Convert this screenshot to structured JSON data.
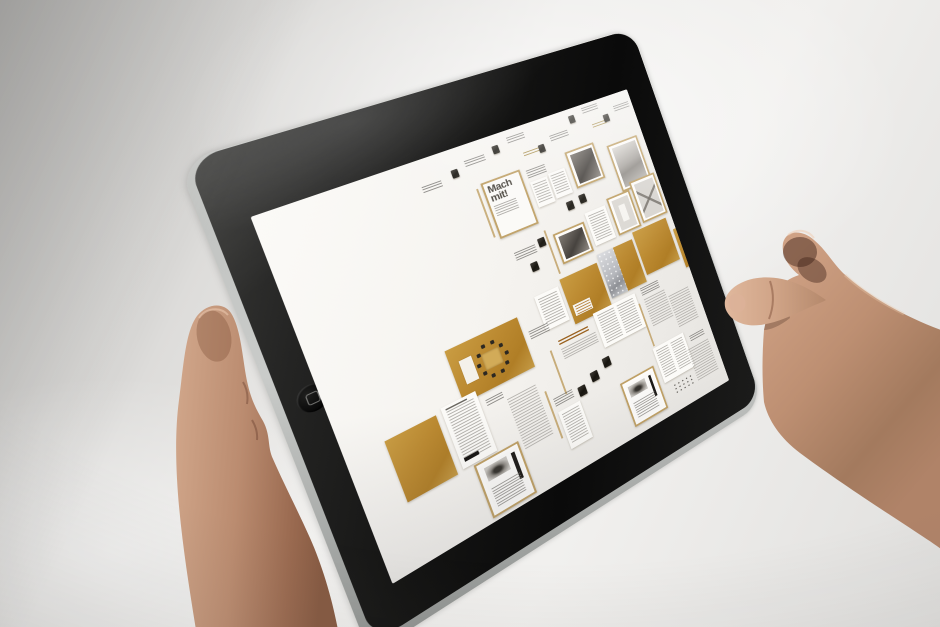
{
  "colors": {
    "accent_orange": "#bb8930",
    "frame_tan": "#bfa065",
    "paper": "#f5f3ef",
    "rim_silver": "#c9cbc9",
    "skin_light": "#d8b098",
    "skin_mid": "#c2987c",
    "skin_dark": "#8d5f48"
  },
  "screen": {
    "cover_title": "Mach mit!",
    "items": [
      {
        "t": "caption",
        "x": 148,
        "y": 28,
        "w": 20,
        "h": 7
      },
      {
        "t": "thumb",
        "x": 180,
        "y": 22,
        "w": 7,
        "h": 9
      },
      {
        "t": "caption",
        "x": 196,
        "y": 17,
        "w": 22,
        "h": 7
      },
      {
        "t": "thumb",
        "x": 228,
        "y": 12,
        "w": 7,
        "h": 9
      },
      {
        "t": "caption",
        "x": 246,
        "y": 8,
        "w": 20,
        "h": 7
      },
      {
        "t": "hlines",
        "x": 258,
        "y": 30,
        "w": 18,
        "h": 5
      },
      {
        "t": "thumb",
        "x": 276,
        "y": 28,
        "w": 7,
        "h": 9
      },
      {
        "t": "caption",
        "x": 292,
        "y": 22,
        "w": 22,
        "h": 7
      },
      {
        "t": "thumb",
        "x": 320,
        "y": 8,
        "w": 7,
        "h": 9
      },
      {
        "t": "caption",
        "x": 338,
        "y": 4,
        "w": 20,
        "h": 7
      },
      {
        "t": "hlines",
        "x": 344,
        "y": 26,
        "w": 18,
        "h": 5
      },
      {
        "t": "thumb",
        "x": 360,
        "y": 20,
        "w": 7,
        "h": 9
      },
      {
        "t": "caption",
        "x": 376,
        "y": 14,
        "w": 20,
        "h": 7
      },
      {
        "t": "vline",
        "x": 198,
        "y": 50,
        "w": 2,
        "h": 56
      },
      {
        "t": "cover",
        "x": 204,
        "y": 46,
        "w": 44,
        "h": 64
      },
      {
        "t": "caption",
        "x": 254,
        "y": 50,
        "w": 22,
        "h": 9
      },
      {
        "t": "textpage",
        "x": 254,
        "y": 64,
        "w": 20,
        "h": 30
      },
      {
        "t": "textpage",
        "x": 276,
        "y": 62,
        "w": 20,
        "h": 30
      },
      {
        "t": "framed",
        "v": "dark",
        "x": 302,
        "y": 46,
        "w": 36,
        "h": 44
      },
      {
        "t": "thumb",
        "x": 284,
        "y": 100,
        "w": 8,
        "h": 10
      },
      {
        "t": "thumb",
        "x": 300,
        "y": 98,
        "w": 8,
        "h": 10
      },
      {
        "t": "framed",
        "v": "photo",
        "x": 352,
        "y": 56,
        "w": 40,
        "h": 58
      },
      {
        "t": "caption",
        "x": 340,
        "y": 122,
        "w": 20,
        "h": 7
      },
      {
        "t": "vline",
        "x": 250,
        "y": 120,
        "w": 2,
        "h": 52
      },
      {
        "t": "caption",
        "x": 212,
        "y": 130,
        "w": 24,
        "h": 9
      },
      {
        "t": "thumb",
        "x": 240,
        "y": 126,
        "w": 8,
        "h": 10
      },
      {
        "t": "thumb",
        "x": 224,
        "y": 148,
        "w": 8,
        "h": 10
      },
      {
        "t": "framed",
        "v": "dark",
        "x": 258,
        "y": 128,
        "w": 38,
        "h": 36
      },
      {
        "t": "textpage",
        "x": 300,
        "y": 120,
        "w": 26,
        "h": 40
      },
      {
        "t": "framed",
        "v": "light",
        "x": 330,
        "y": 114,
        "w": 30,
        "h": 46
      },
      {
        "t": "framed",
        "v": "xpattern",
        "x": 363,
        "y": 106,
        "w": 34,
        "h": 52
      },
      {
        "t": "textpage",
        "x": 216,
        "y": 184,
        "w": 28,
        "h": 40
      },
      {
        "t": "orange",
        "v": "label",
        "x": 248,
        "y": 178,
        "w": 46,
        "h": 54
      },
      {
        "t": "orange",
        "v": "sparkle",
        "x": 297,
        "y": 170,
        "w": 46,
        "h": 54
      },
      {
        "t": "orange",
        "v": "plain",
        "x": 346,
        "y": 163,
        "w": 46,
        "h": 54
      },
      {
        "t": "orange",
        "v": "plain",
        "x": 396,
        "y": 180,
        "w": 40,
        "h": 50
      },
      {
        "t": "orange",
        "v": "table",
        "x": 114,
        "y": 196,
        "w": 78,
        "h": 58
      },
      {
        "t": "caption",
        "x": 198,
        "y": 216,
        "w": 22,
        "h": 9
      },
      {
        "t": "vline",
        "x": 212,
        "y": 246,
        "w": 2,
        "h": 52
      },
      {
        "t": "heading",
        "x": 224,
        "y": 240,
        "w": 42,
        "h": 24
      },
      {
        "t": "textpage2",
        "x": 270,
        "y": 230,
        "w": 54,
        "h": 42
      },
      {
        "t": "vline",
        "x": 324,
        "y": 244,
        "w": 2,
        "h": 54
      },
      {
        "t": "caption",
        "x": 332,
        "y": 228,
        "w": 24,
        "h": 9
      },
      {
        "t": "textcol",
        "x": 332,
        "y": 242,
        "w": 28,
        "h": 36
      },
      {
        "t": "textcol",
        "x": 362,
        "y": 252,
        "w": 28,
        "h": 42
      },
      {
        "t": "orange",
        "v": "plain",
        "x": 36,
        "y": 252,
        "w": 50,
        "h": 66
      },
      {
        "t": "textpage",
        "v": "heads",
        "x": 92,
        "y": 248,
        "w": 36,
        "h": 68
      },
      {
        "t": "caption",
        "x": 134,
        "y": 262,
        "w": 18,
        "h": 7
      },
      {
        "t": "framed",
        "v": "car",
        "x": 102,
        "y": 318,
        "w": 48,
        "h": 60
      },
      {
        "t": "textcol",
        "x": 154,
        "y": 272,
        "w": 32,
        "h": 58
      },
      {
        "t": "vline",
        "x": 192,
        "y": 284,
        "w": 2,
        "h": 56
      },
      {
        "t": "caption",
        "x": 198,
        "y": 296,
        "w": 22,
        "h": 9
      },
      {
        "t": "thumb",
        "x": 226,
        "y": 298,
        "w": 9,
        "h": 11
      },
      {
        "t": "thumb",
        "x": 244,
        "y": 290,
        "w": 9,
        "h": 11
      },
      {
        "t": "thumb",
        "x": 262,
        "y": 282,
        "w": 9,
        "h": 11
      },
      {
        "t": "textpage",
        "x": 198,
        "y": 312,
        "w": 26,
        "h": 44
      },
      {
        "t": "framed",
        "v": "car",
        "x": 272,
        "y": 318,
        "w": 44,
        "h": 54
      },
      {
        "t": "textpage2",
        "x": 322,
        "y": 300,
        "w": 42,
        "h": 44
      },
      {
        "t": "icons",
        "x": 330,
        "y": 350,
        "w": 28,
        "h": 14
      },
      {
        "t": "caption",
        "x": 370,
        "y": 308,
        "w": 20,
        "h": 7
      },
      {
        "t": "textcol",
        "x": 362,
        "y": 322,
        "w": 30,
        "h": 40
      }
    ]
  }
}
